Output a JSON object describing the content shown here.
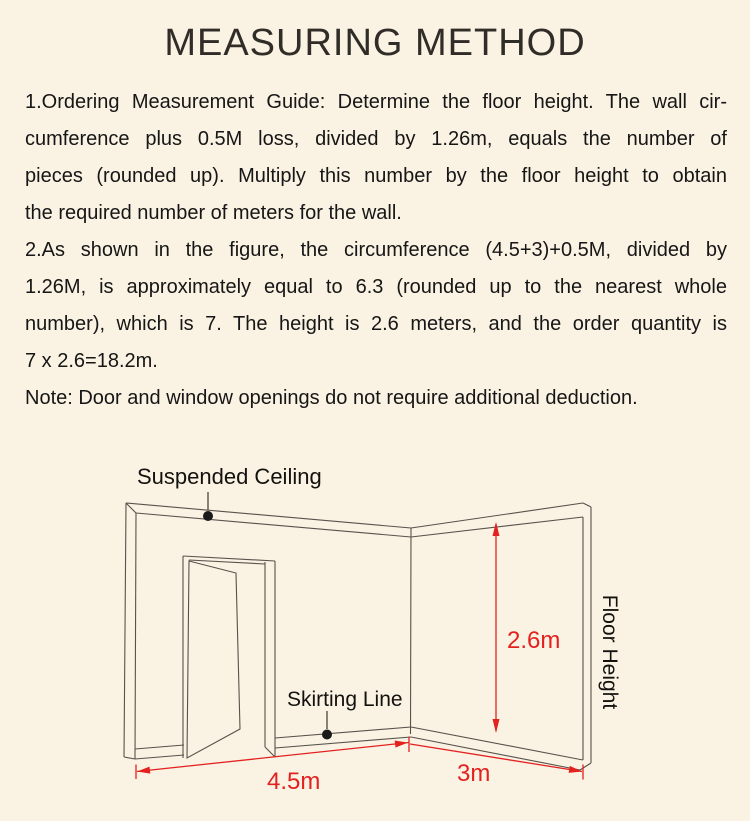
{
  "page": {
    "title": "MEASURING METHOD",
    "background_color": "#faf2e3",
    "text_color": "#161616",
    "accent_red": "#e32220",
    "line_color": "#57524b"
  },
  "instructions": {
    "para1_lines": [
      "1.Ordering Measurement Guide: Determine the floor height. The wall cir-",
      "cumference plus 0.5M loss, divided by 1.26m, equals the number of",
      "pieces (rounded up). Multiply this number by the floor height to obtain",
      "the required number of meters for the wall."
    ],
    "para2_lines": [
      "2.As shown in the figure, the circumference (4.5+3)+0.5M, divided by",
      "1.26M, is approximately equal to 6.3 (rounded up to the nearest whole",
      "number), which is 7. The height is 2.6 meters, and the order quantity is",
      "7 x 2.6=18.2m."
    ],
    "note": "Note: Door and window openings do not require additional deduction."
  },
  "diagram": {
    "labels": {
      "suspended_ceiling": "Suspended Ceiling",
      "skirting_line": "Skirting Line",
      "floor_height": "Floor Height"
    },
    "dimensions": {
      "wall_height": "2.6m",
      "left_wall_length": "4.5m",
      "right_wall_length": "3m"
    }
  }
}
